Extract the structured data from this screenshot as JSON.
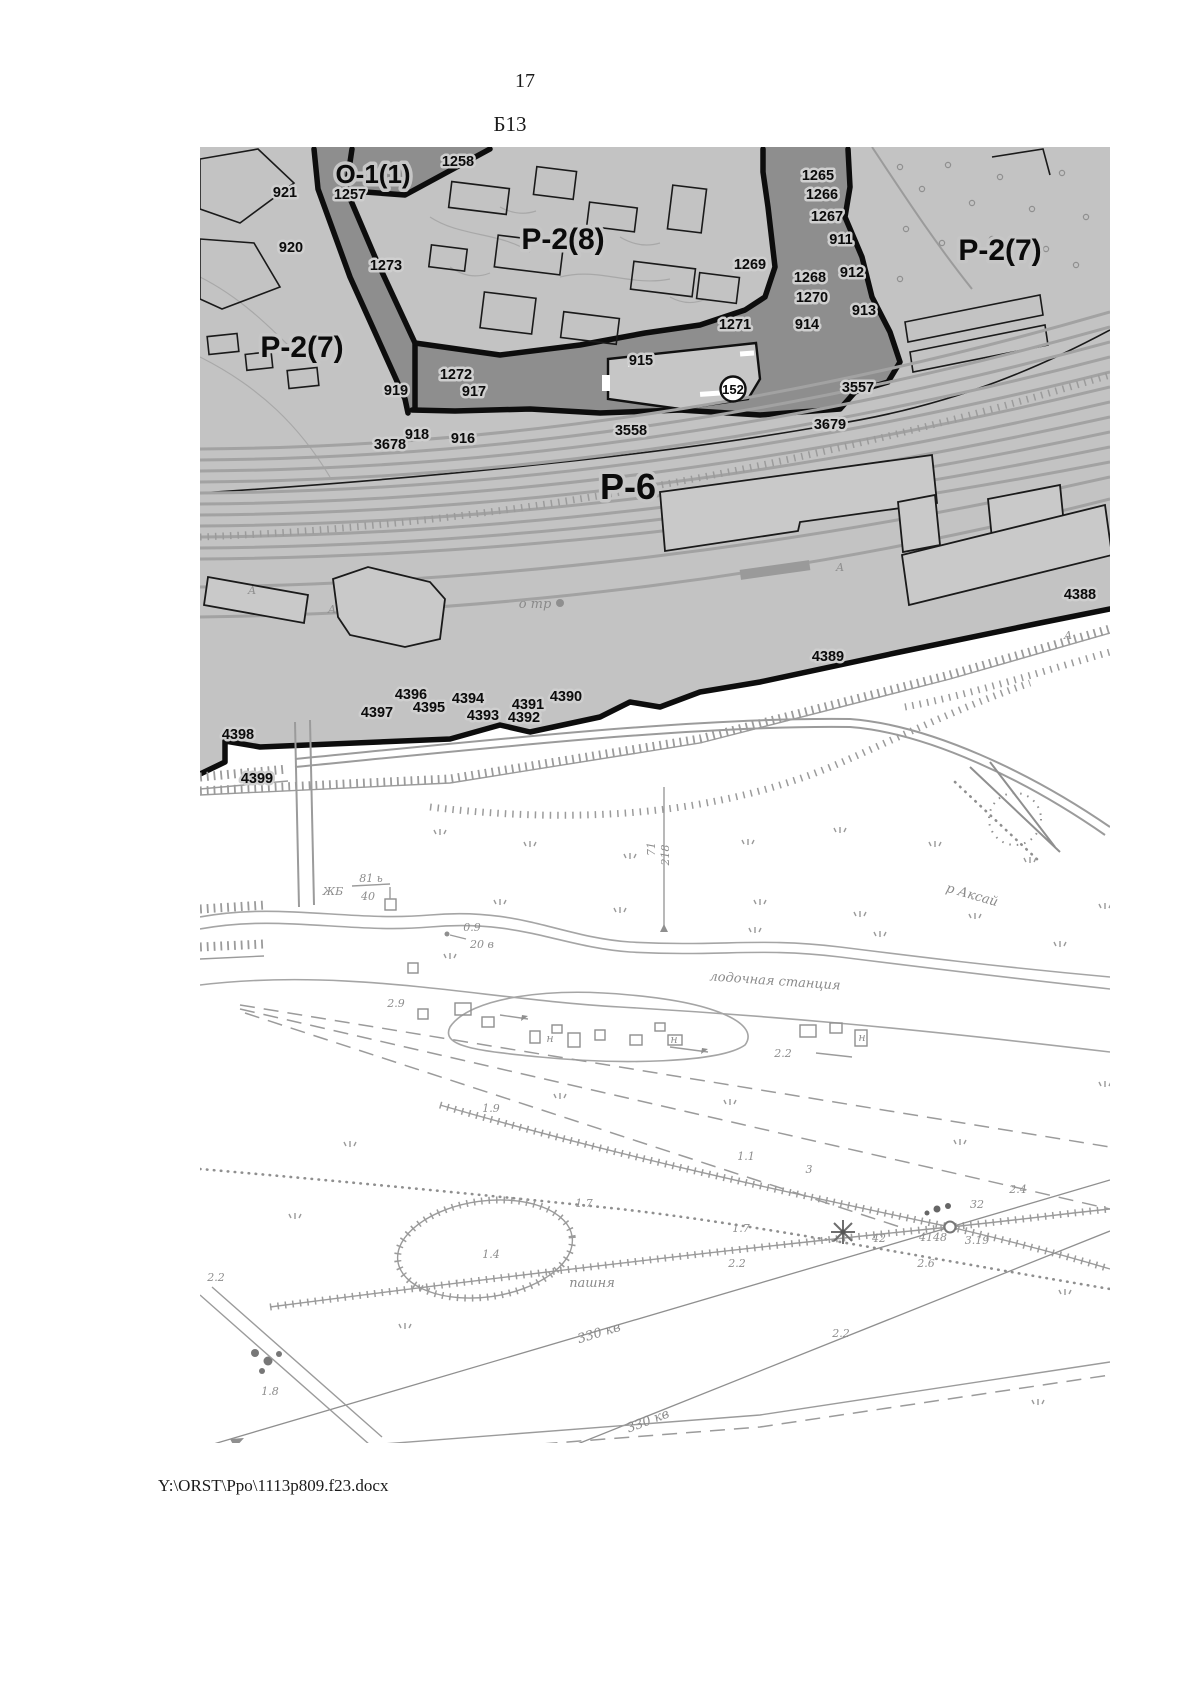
{
  "page": {
    "number": "17",
    "map_title": "Б13",
    "footer_path": "Y:\\ORST\\Ppo\\1113p809.f23.docx"
  },
  "map": {
    "zones": {
      "o1": "О-1(1)",
      "r2_8": "Р-2(8)",
      "r2_7": "Р-2(7)",
      "r6": "Р-6"
    },
    "site_circle": "152",
    "parcels": {
      "p921": "921",
      "p920": "920",
      "p1257": "1257",
      "p1258": "1258",
      "p1273": "1273",
      "p1265": "1265",
      "p1266": "1266",
      "p1267": "1267",
      "p911": "911",
      "p912": "912",
      "p913": "913",
      "p914": "914",
      "p1268": "1268",
      "p1269": "1269",
      "p1270": "1270",
      "p1271": "1271",
      "p1272": "1272",
      "p915": "915",
      "p916": "916",
      "p917": "917",
      "p918": "918",
      "p919": "919",
      "p3557": "3557",
      "p3558": "3558",
      "p3678": "3678",
      "p3679": "3679",
      "p4388": "4388",
      "p4389": "4389",
      "p4390": "4390",
      "p4391": "4391",
      "p4392": "4392",
      "p4393": "4393",
      "p4394": "4394",
      "p4395": "4395",
      "p4396": "4396",
      "p4397": "4397",
      "p4398": "4398",
      "p4399": "4399"
    },
    "topo": {
      "river": "р Аксай",
      "boat_station": "лодочная станция",
      "arable": "пашня",
      "power_line": "330 кв",
      "otr": "о тр",
      "letter_a": "А",
      "letter_n": "н",
      "bridge": {
        "abbr": "ЖБ",
        "load_top": "81 ь",
        "load_bottom": "40"
      }
    },
    "spots": {
      "v0_9": "0.9",
      "v20": "20 в",
      "v71": "71",
      "v218": "218",
      "v2_9": "2.9",
      "v2_2": "2.2",
      "v1_9": "1.9",
      "v1_7": "1.7",
      "v1_1": "1.1",
      "v3": "3",
      "v1_4": "1.4",
      "v2_4": "2.4",
      "v32": "32",
      "v42": "42",
      "v4148": "4148",
      "v3_19": "3.19",
      "v2_6": "2.6",
      "v1_8": "1.8"
    }
  }
}
